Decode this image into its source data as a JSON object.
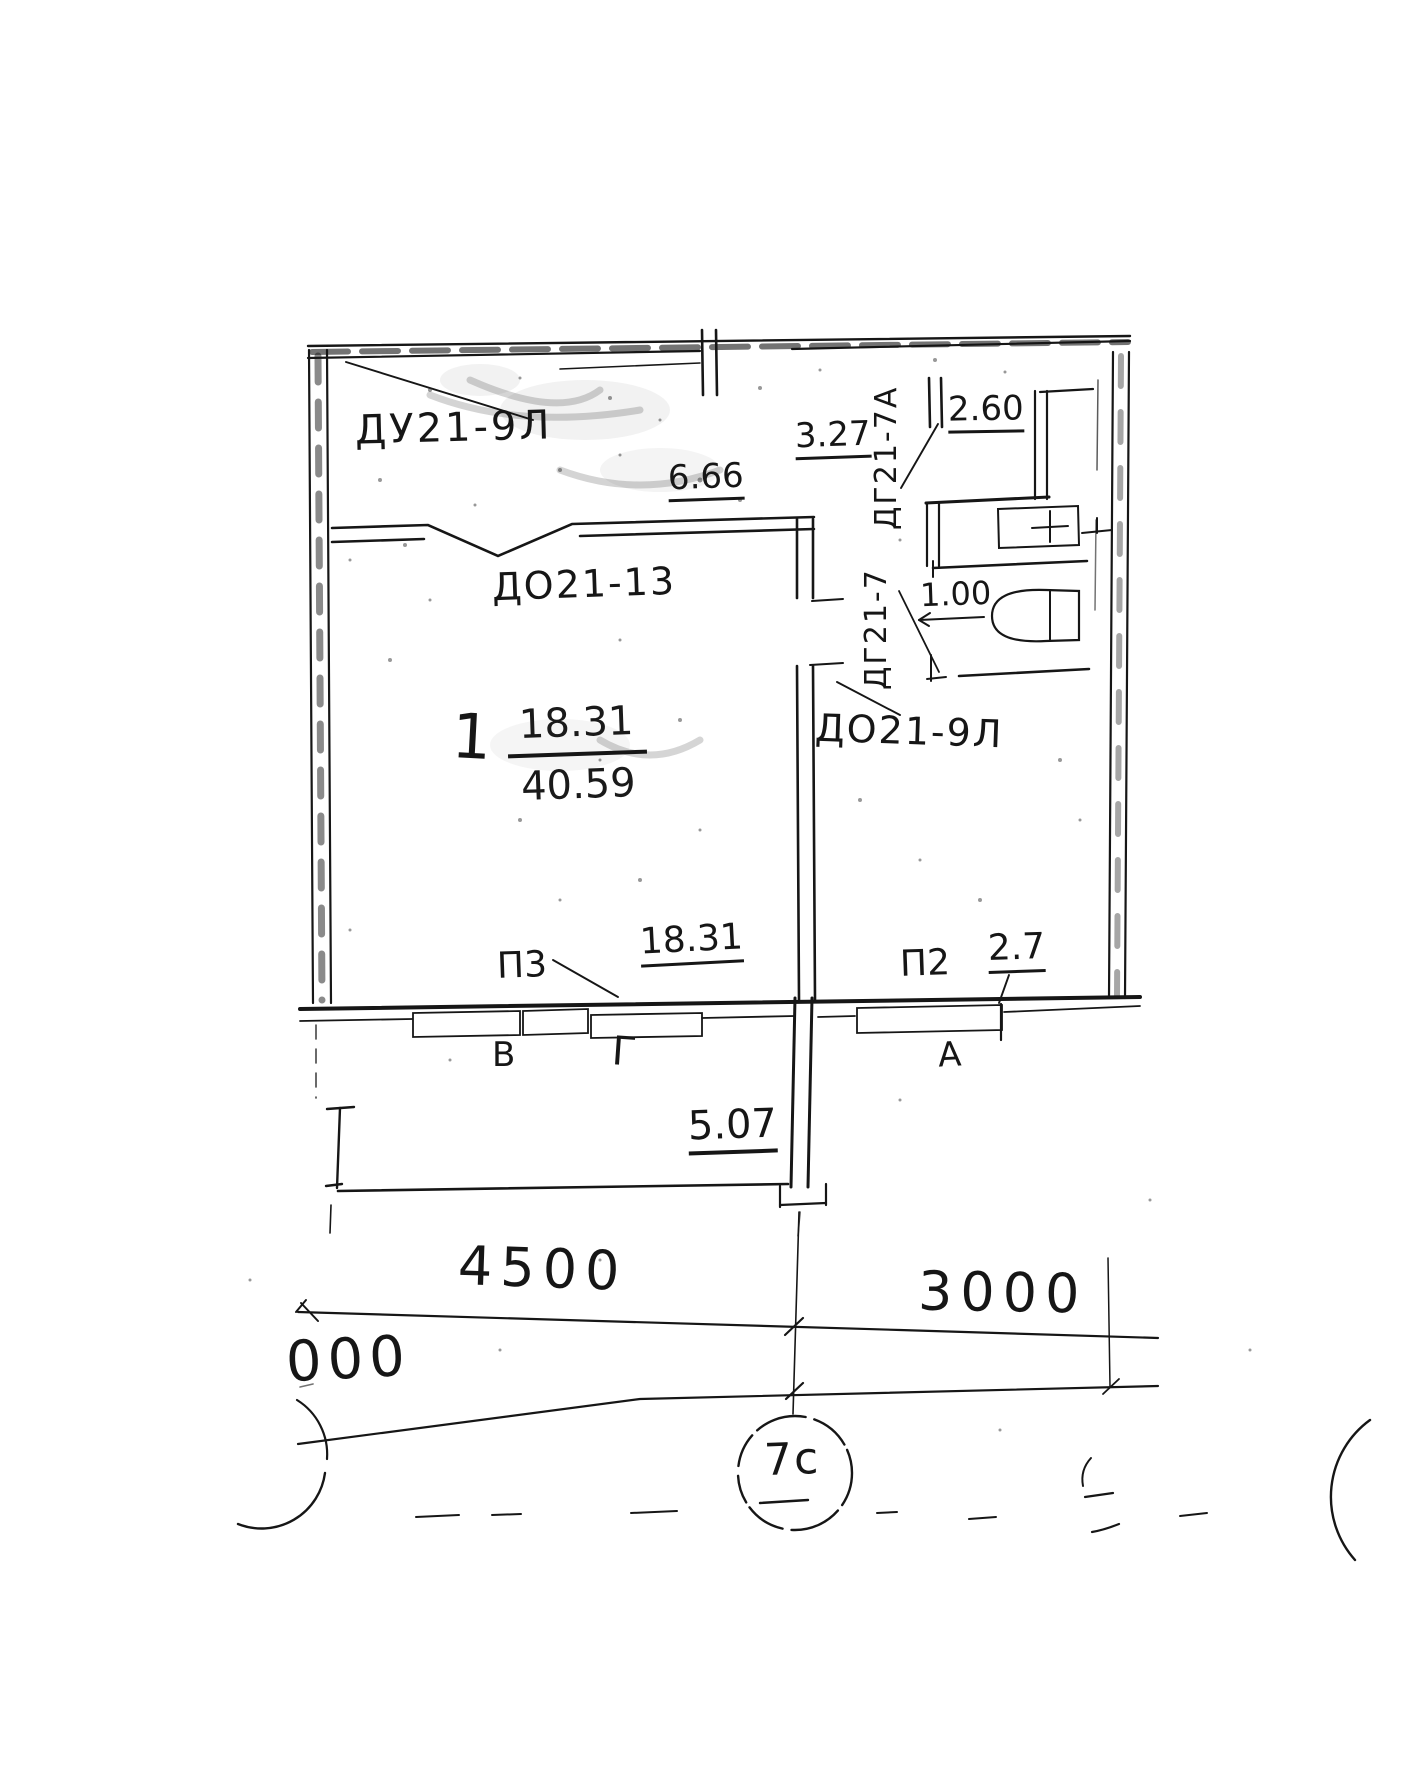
{
  "page": {
    "background": "#ffffff",
    "ink": "#1a1a1a"
  },
  "plan": {
    "room": {
      "number": "1",
      "area_living": "18.31",
      "area_total": "40.59"
    },
    "labels": {
      "door_top_left": "ДУ21-9Л",
      "window_main": "ДО21-13",
      "door_rot_upper": "ДГ21-7А",
      "door_rot_lower": "ДГ21-7",
      "door_hall": "ДО21-9Л"
    },
    "dims": {
      "hall": "6.66",
      "top_opening": "3.27",
      "bath": "2.60",
      "wc": "1.00",
      "room_window": "18.31",
      "window_p2": "2.7",
      "balcony": "5.07",
      "span_left": "4500",
      "span_right": "3000",
      "span_cut": "000"
    },
    "marks": {
      "window_p3": "П3",
      "window_p2": "П2",
      "win_v": "В",
      "win_g": "Г",
      "win_a": "А"
    },
    "axes": {
      "c7": "7с"
    }
  }
}
